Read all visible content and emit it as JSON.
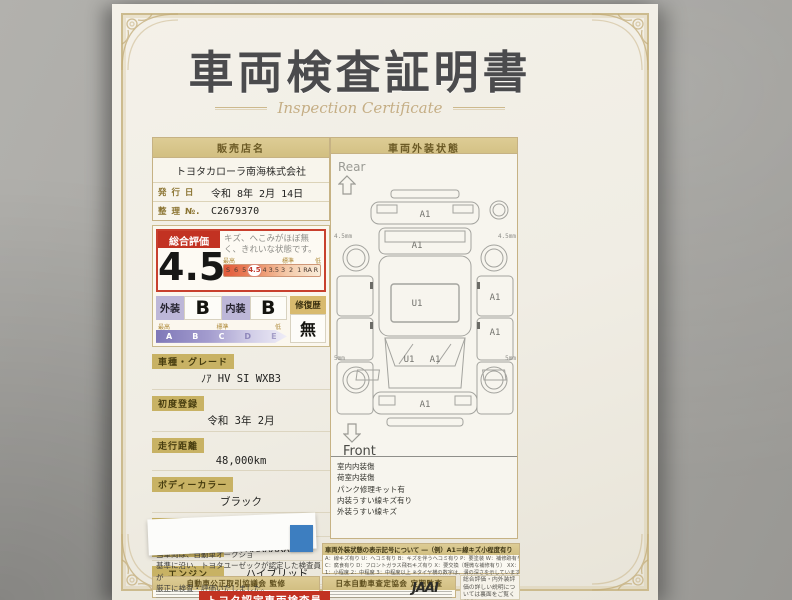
{
  "title": {
    "main": "車両検査証明書",
    "sub": "Inspection Certificate"
  },
  "seller": {
    "header": "販売店名",
    "name": "トヨタカローラ南海株式会社",
    "issue_label": "発 行 日",
    "issue_value": "令和 8年 2月 14日",
    "ref_label": "整 理 №.",
    "ref_value": "C2679370"
  },
  "rating": {
    "label": "総合評価",
    "score": "4.5",
    "comment": "キズ、へこみがほぼ無く、きれいな状態です。",
    "scale_high": "最高",
    "scale_mid": "標準",
    "scale_low": "低",
    "scale": [
      "S",
      "6",
      "5",
      "4.5",
      "4",
      "3.5",
      "3",
      "2",
      "1",
      "RA",
      "R"
    ],
    "selected": "4.5",
    "exterior_label": "外装",
    "exterior_grade": "B",
    "interior_label": "内装",
    "interior_grade": "B",
    "repair_label": "修復歴",
    "repair_value": "無",
    "grades": [
      "A",
      "B",
      "C",
      "D",
      "E"
    ]
  },
  "vehicle": {
    "fields_stacked": [
      {
        "label": "車種・グレード",
        "value": "ﾉｱ HV SI WXB3"
      },
      {
        "label": "初度登録",
        "value": "令和 3年 2月"
      },
      {
        "label": "走行距離",
        "value": "48,000km"
      },
      {
        "label": "ボディーカラー",
        "value": "ブラック"
      }
    ],
    "fields_inline": [
      {
        "label": "型　式",
        "value": "6AA-ZWR80W"
      },
      {
        "label": "車台番号",
        "value": "XXXXXXX083"
      },
      {
        "label": "エンジン",
        "value": "ハイブリッド"
      }
    ],
    "inspector_badge": "トヨタ認定車両検査員"
  },
  "disclaimer": {
    "line1": "当車両は、自動車オークショ",
    "line2": "基準に沿い、トヨタユーゼックが認定した検査員が",
    "line3": "厳正に検査・評価いたしました。"
  },
  "footer": {
    "left_bar": "自動車公正取引協議会 監修",
    "mid_bar": "日本自動車査定協会 定期監査",
    "jaai_logo": "JAAI"
  },
  "legend": {
    "header": "車両外装状態の表示記号について",
    "example": "―（例）A1＝線キズ小程度有り",
    "line1": "A：線キズ有り U：ヘコミ有り B：キズを伴うヘコミ有り P：要塗装 W：補修跡有り S：サビ有り",
    "line2": "C：腐食有り D：フロントガラス飛石キズ有り X：要交換（軽微な補修有り） XX：交換歴有り",
    "line3": "1：小程度 2：中程度 3：中程度以上 ※タイヤ横の数字は、溝の深さを示しています。"
  },
  "info_box": {
    "text": "総合評価・内外装評価の詳しい説明については裏面をご覧ください。"
  },
  "exterior": {
    "header": "車両外装状態",
    "rear_label": "Rear",
    "front_label": "Front",
    "marks": [
      {
        "part": "rear-bumper",
        "code": "A1"
      },
      {
        "part": "back-door",
        "code": "A1"
      },
      {
        "part": "roof-center",
        "code": "U1"
      },
      {
        "part": "right-front-door",
        "code": "A1"
      },
      {
        "part": "right-rear-quarter",
        "code": "A1"
      },
      {
        "part": "hood-left",
        "code": "U1"
      },
      {
        "part": "hood-right",
        "code": "A1"
      },
      {
        "part": "front-bumper",
        "code": "A1"
      }
    ],
    "tires": [
      {
        "pos": "rear-left",
        "depth": "4.5mm"
      },
      {
        "pos": "rear-right",
        "depth": "4.5mm"
      },
      {
        "pos": "front-left",
        "depth": "5mm"
      },
      {
        "pos": "front-right",
        "depth": "5mm"
      }
    ],
    "notes": [
      "室内内装傷",
      "荷室内装傷",
      "パンク修理キット有",
      "内装うすい線キズ有り",
      "外装うすい線キズ"
    ]
  }
}
